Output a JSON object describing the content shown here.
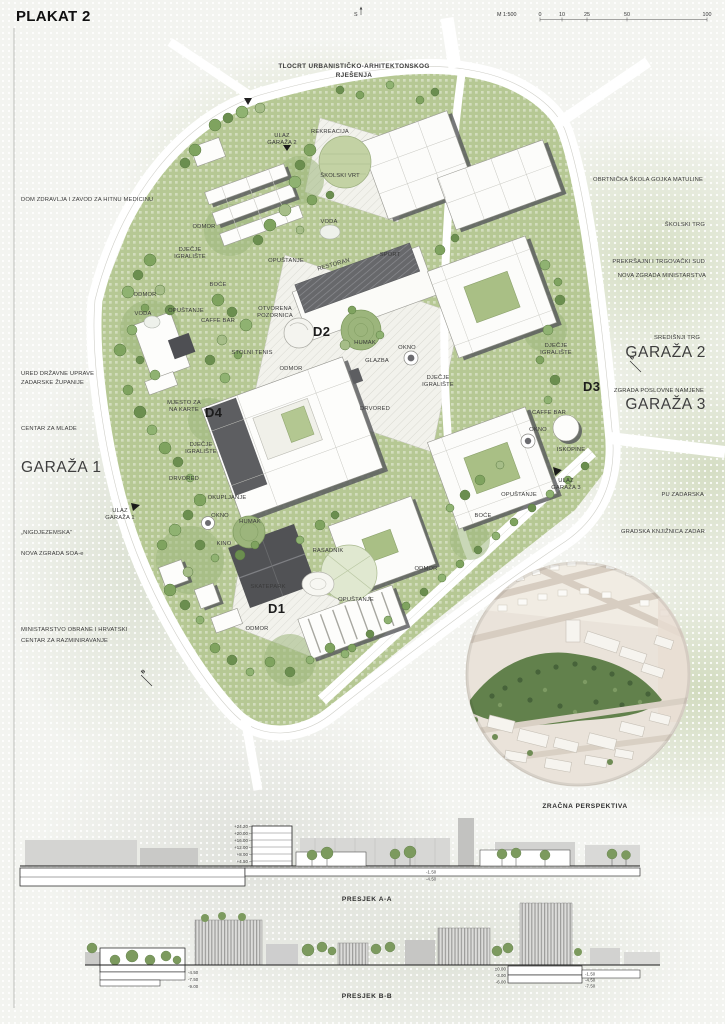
{
  "header": {
    "title": "PLAKAT 2",
    "north": "S",
    "scale_label": "M 1:500",
    "scale_ticks": [
      "0",
      "10",
      "25",
      "50",
      "100"
    ]
  },
  "map": {
    "title_line1": "TLOCRT URBANISTIČKO-ARHITEKTONSKOG",
    "title_line2": "RJEŠENJA",
    "zones": {
      "d1": "D1",
      "d2": "D2",
      "d3": "D3",
      "d4": "D4"
    },
    "markers": {
      "b1": "B",
      "b2": "B"
    },
    "periphery": {
      "dom_zdravlja": "DOM ZDRAVLJA I ZAVOD ZA HITNU MEDICINU",
      "ured_l1": "URED DRŽAVNE UPRAVE",
      "ured_l2": "ZADARSKE ŽUPANIJE",
      "centar_za_mlade": "CENTAR ZA MLADE",
      "garaza_1": "GARAŽA 1",
      "nigdjezemska": "„NIGDJEZEMSKA“",
      "nova_zgrada_soa": "NOVA ZGRADA SOA-e",
      "ministarstvo_l1": "MINISTARSTVO OBRANE I HRVATSKI",
      "ministarstvo_l2": "CENTAR ZA RAZMINIRAVANJE",
      "obrtnicka_skola": "OBRTNIČKA ŠKOLA GOJKA MATULINE",
      "skolski_trg": "ŠKOLSKI TRG",
      "prekrsajni_sud": "PREKRŠAJNI  I TRGOVAČKI SUD",
      "nova_zgrada_ministarstva": "NOVA ZGRADA MINISTARSTVA",
      "sredisnji_trg": "SREDIŠNJI TRG",
      "garaza_2": "GARAŽA 2",
      "zgrada_poslovne": "ZGRADA POSLOVNE NAMJENE",
      "garaza_3": "GARAŽA 3",
      "pu_zadarska": "PU ZADARSKA",
      "knjiznica": "GRADSKA KNJIŽNICA ZADAR"
    },
    "interior": {
      "ulaz_garaza2_l1": "ULAZ",
      "ulaz_garaza2_l2": "GARAŽA 2",
      "rekreacija": "REKREACIJA",
      "skolski_vrt": "ŠKOLSKI VRT",
      "voda_1": "VODA",
      "odmor_1": "ODMOR",
      "djecje_1_l1": "DJEČJE",
      "djecje_1_l2": "IGRALIŠTE",
      "opustanje_1": "OPUŠTANJE",
      "boce_1": "BOĆE",
      "odmor_2": "ODMOR",
      "voda_2": "VODA",
      "opustanje_2": "OPUŠTANJE",
      "caffe_bar_1": "CAFFE BAR",
      "otvorena_l1": "OTVORENA",
      "otvorena_l2": "POZORNICA",
      "stolni_tenis": "STOLNI TENIS",
      "restoran": "RESTORAN",
      "sport": "SPORT",
      "humak_1": "HUMAK",
      "okno_1": "OKNO",
      "glazba": "GLAZBA",
      "djecje_2_l1": "DJEČJE",
      "djecje_2_l2": "IGRALIŠTE",
      "drvored_1": "DRVORED",
      "odmor_3": "ODMOR",
      "mjesto_l1": "MJESTO ZA",
      "mjesto_l2": "NA KARTE",
      "djecje_3_l1": "DJEČJE",
      "djecje_3_l2": "IGRALIŠTE",
      "drvored_2": "DRVORED",
      "okupljanje": "OKUPLJANJE",
      "okno_2": "OKNO",
      "humak_2": "HUMAK",
      "kino": "KINO",
      "rasadnik": "RASADNIK",
      "skatepark": "SKATEPARK",
      "opustanje_3": "OPUŠTANJE",
      "odmor_4": "ODMOR",
      "odmor_5": "ODMOR",
      "opustanje_4": "OPUŠTANJE",
      "boce_2": "BOĆE",
      "djecje_4_l1": "DJEČJE",
      "djecje_4_l2": "IGRALIŠTE",
      "caffe_bar_2": "CAFFE BAR",
      "okno_3": "OKNO",
      "iskopine": "ISKOPINE",
      "ulaz_garaza3_l1": "ULAZ",
      "ulaz_garaza3_l2": "GARAŽA 3",
      "ulaz_garaza1_l1": "ULAZ",
      "ulaz_garaza1_l2": "GARAŽA 1"
    }
  },
  "perspective": {
    "caption": "ZRAČNA PERSPEKTIVA"
  },
  "sections": {
    "a": {
      "caption": "PRESJEK A-A",
      "elevations": [
        "+24.20",
        "+20.00",
        "+16.00",
        "+12.00",
        "+8.00",
        "+4.50"
      ],
      "right_elevations": [
        "-1.50",
        "-4.50"
      ]
    },
    "b": {
      "caption": "PRESJEK B-B",
      "left_elevations": [
        "-4.50",
        "-7.50",
        "-9.00"
      ],
      "mid_elevations": [
        "±0.00",
        "-3.00",
        "-6.00"
      ],
      "right_elevations": [
        "-1.50",
        "-4.50",
        "-7.50"
      ]
    }
  }
}
